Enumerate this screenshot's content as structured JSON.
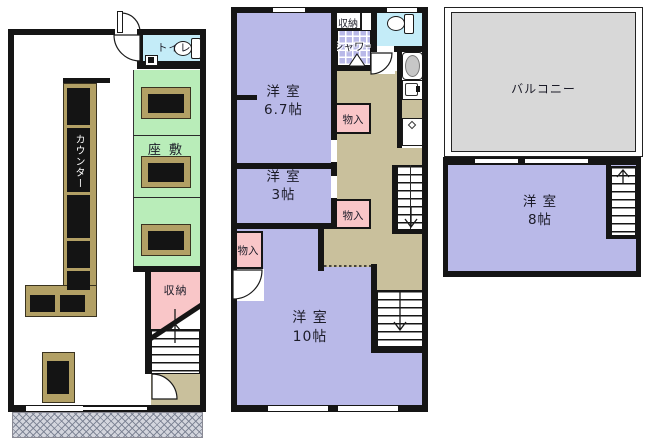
{
  "colors": {
    "wall": "#151515",
    "room_purple": "#b9b9e8",
    "tatami_green": "#b9edb9",
    "toilet_blue": "#c4ecf8",
    "closet_pink": "#f9c6c8",
    "hallway_tan": "#c9c09c",
    "counter_tan": "#b2a065",
    "balcony_grey": "#d8d8d8"
  },
  "floor1": {
    "toilet": "トイレ",
    "zashiki": "座 敷",
    "counter": "カウンター",
    "storage": "収納"
  },
  "floor2": {
    "storage": "収納",
    "shower": "シャワー",
    "room67_name": "洋 室",
    "room67_size": "6.7帖",
    "room3_name": "洋 室",
    "room3_size": "3帖",
    "closet_a": "物入",
    "closet_b": "物入",
    "closet_c": "物入",
    "room10_name": "洋 室",
    "room10_size": "10帖"
  },
  "floor3": {
    "balcony": "バルコニー",
    "room8_name": "洋 室",
    "room8_size": "8帖"
  }
}
